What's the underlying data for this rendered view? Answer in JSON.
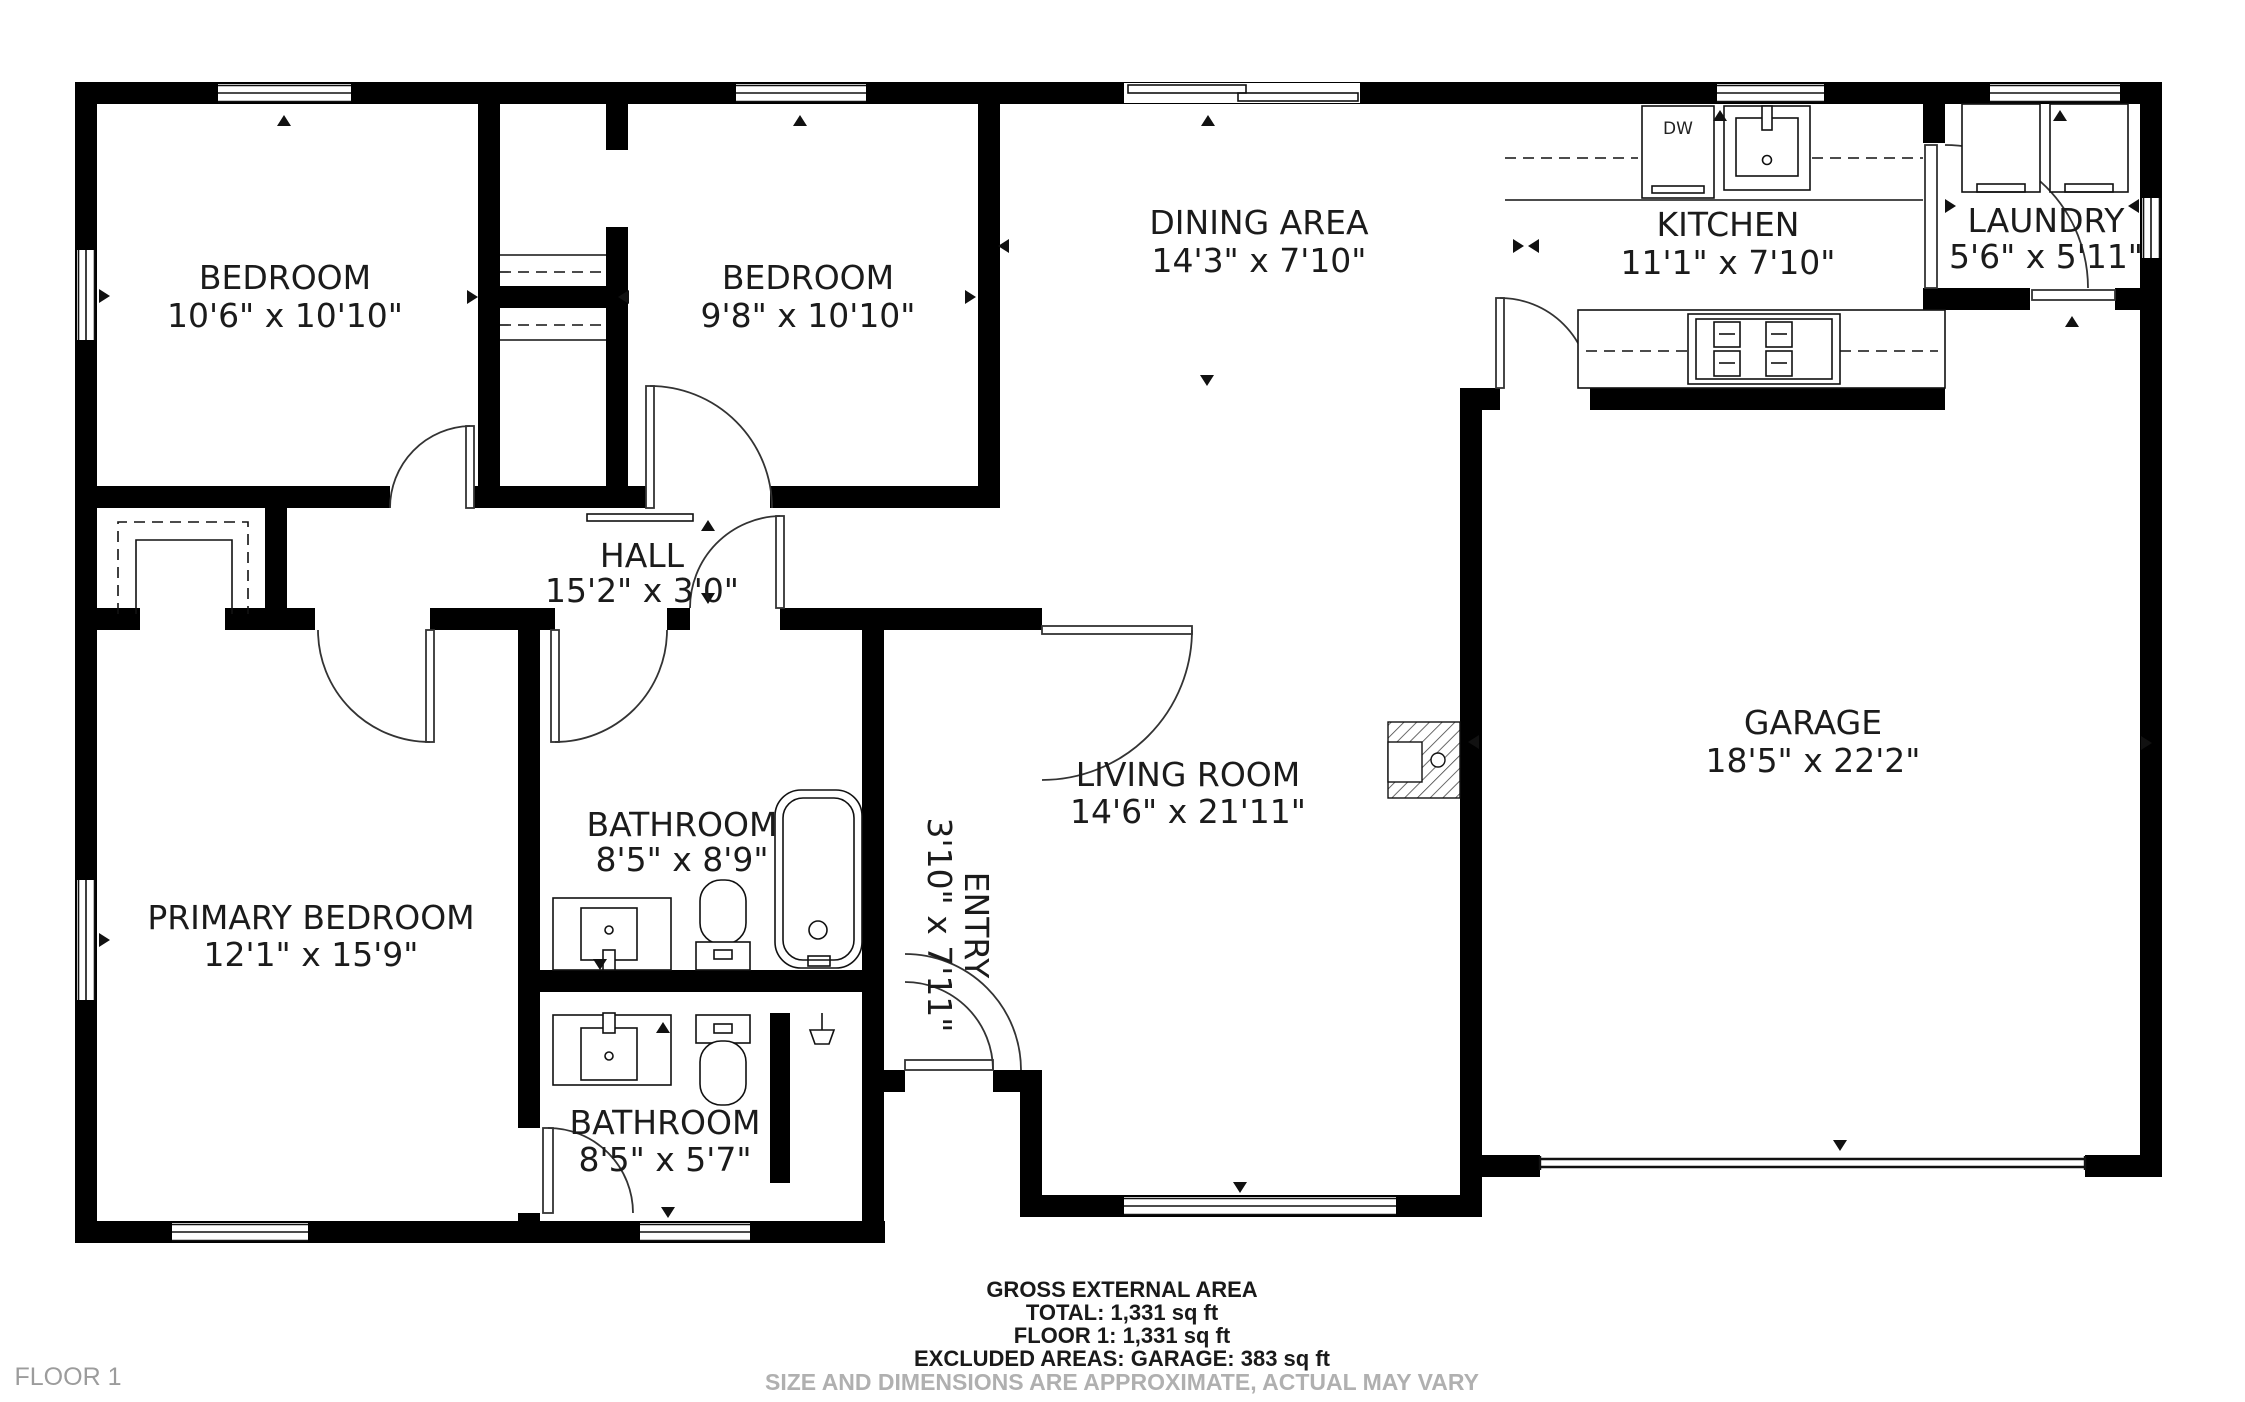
{
  "title": "Floor plan - Floor 1",
  "floor_label": "FLOOR 1",
  "rooms": [
    {
      "id": "bedroom-1",
      "name": "BEDROOM",
      "dims": "10'6\" x 10'10\""
    },
    {
      "id": "bedroom-2",
      "name": "BEDROOM",
      "dims": "9'8\" x 10'10\""
    },
    {
      "id": "dining-area",
      "name": "DINING AREA",
      "dims": "14'3\" x 7'10\""
    },
    {
      "id": "kitchen",
      "name": "KITCHEN",
      "dims": "11'1\" x 7'10\""
    },
    {
      "id": "laundry",
      "name": "LAUNDRY",
      "dims": "5'6\" x 5'11\""
    },
    {
      "id": "hall",
      "name": "HALL",
      "dims": "15'2\" x 3'0\""
    },
    {
      "id": "garage",
      "name": "GARAGE",
      "dims": "18'5\" x 22'2\""
    },
    {
      "id": "primary-bedroom",
      "name": "PRIMARY BEDROOM",
      "dims": "12'1\" x 15'9\""
    },
    {
      "id": "bathroom-1",
      "name": "BATHROOM",
      "dims": "8'5\" x 8'9\""
    },
    {
      "id": "bathroom-2",
      "name": "BATHROOM",
      "dims": "8'5\" x 5'7\""
    },
    {
      "id": "entry",
      "name": "ENTRY",
      "dims": "3'10\" x 7'11\""
    },
    {
      "id": "living-room",
      "name": "LIVING ROOM",
      "dims": "14'6\" x 21'11\""
    }
  ],
  "fixtures": {
    "dishwasher_label": "DW"
  },
  "footer": {
    "title": "GROSS EXTERNAL AREA",
    "total": "TOTAL: 1,331 sq ft",
    "floor": "FLOOR 1: 1,331 sq ft",
    "excluded": "EXCLUDED AREAS: GARAGE: 383 sq ft",
    "disclaimer": "SIZE AND DIMENSIONS ARE APPROXIMATE, ACTUAL MAY VARY"
  },
  "colors": {
    "walls": "#000000",
    "label_text": "#1b1b1b",
    "muted_text": "#b0b0b0"
  }
}
